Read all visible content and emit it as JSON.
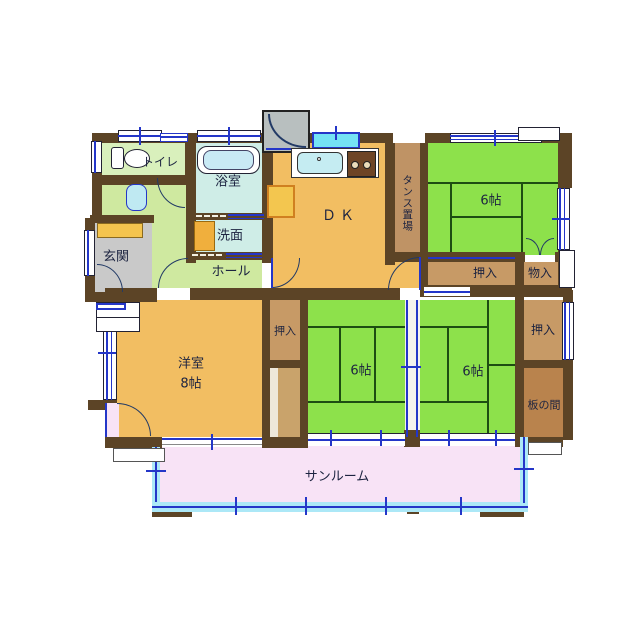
{
  "rooms": {
    "toilet": {
      "label": "トイレ"
    },
    "bath": {
      "label": "浴室"
    },
    "washroom": {
      "label": "洗面"
    },
    "entrance": {
      "label": "玄関"
    },
    "hall": {
      "label": "ホール"
    },
    "dining_kitchen": {
      "label": "ＤＫ"
    },
    "tansu_storage": {
      "label": "タンス置場"
    },
    "tatami_ne": {
      "label": "6帖"
    },
    "closet_ne": {
      "label": "押入"
    },
    "storage_ne": {
      "label": "物入"
    },
    "western_room": {
      "label": "洋室",
      "size": "8帖"
    },
    "closet_w": {
      "label": "押入"
    },
    "tatami_s1": {
      "label": "6帖"
    },
    "tatami_s2": {
      "label": "6帖"
    },
    "closet_e": {
      "label": "押入"
    },
    "itanoma": {
      "label": "板の間"
    },
    "sunroom": {
      "label": "サンルーム"
    }
  },
  "colors": {
    "wall": "#5C4426",
    "tatami_green": "#8DE14B",
    "wood_floor_orange": "#F2BE62",
    "hall_floor_green": "#CFE9A0",
    "wet_area_cyan": "#CFEDE7",
    "entrance_gray": "#C9C9C9",
    "closet_tan": "#C79A66",
    "itanoma_brown": "#B9834D",
    "sunroom_pink": "#F8E3F6",
    "glass_cyan": "#ACE8F7",
    "window_line_blue": "#2436C8"
  }
}
